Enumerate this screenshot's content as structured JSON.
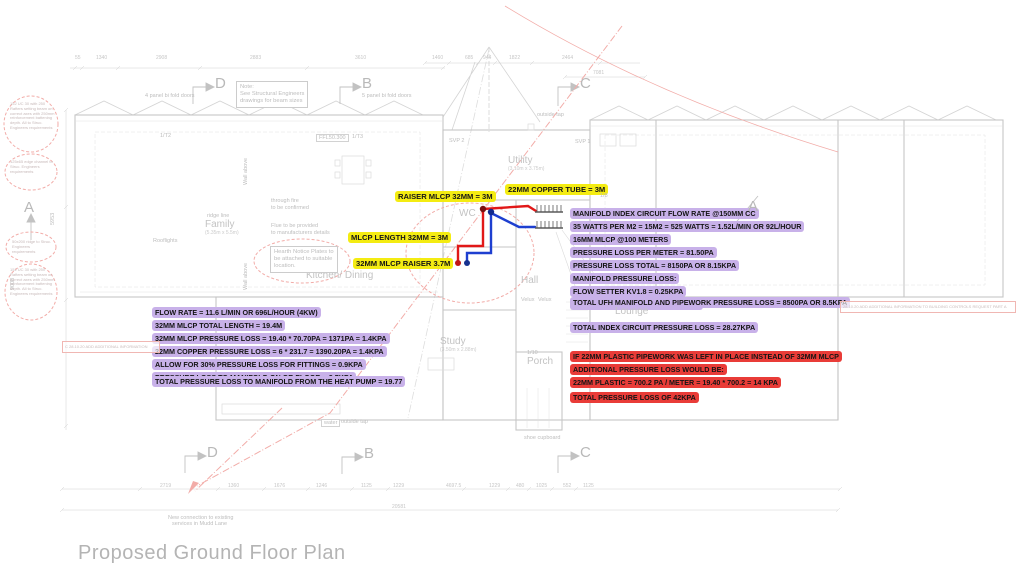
{
  "title": "Proposed Ground Floor Plan",
  "colors": {
    "yellow_highlight": "#f4ec12",
    "purple_highlight": "#c8b1e9",
    "red_highlight": "#e93c38",
    "pink_revision": "#f2aca8",
    "plan_gray": "#c9c9c9",
    "pipe_flow_red": "#e11818",
    "pipe_return_blue": "#1e3fd0"
  },
  "callouts": [
    {
      "color": "yellow",
      "x": 395,
      "y": 190,
      "lines": [
        "RAISER MLCP 32MM = 3M"
      ]
    },
    {
      "color": "yellow",
      "x": 505,
      "y": 183,
      "lines": [
        "22MM COPPER TUBE = 3M"
      ]
    },
    {
      "color": "yellow",
      "x": 348,
      "y": 231,
      "lines": [
        "MLCP LENGTH 32MM = 3M"
      ]
    },
    {
      "color": "yellow",
      "x": 353,
      "y": 257,
      "lines": [
        "32MM MLCP RAISER 3.7M"
      ]
    },
    {
      "color": "purple",
      "x": 570,
      "y": 207,
      "lines": [
        "MANIFOLD INDEX CIRCUIT FLOW RATE @150MM CC",
        "35 WATTS PER M2 = 15M2 = 525 WATTS = 1.52L/MIN OR 92L/HOUR",
        "16MM MLCP @100 METERS",
        "PRESSURE LOSS PER METER = 81.50PA",
        "PRESSURE LOSS TOTAL = 8150PA OR 8.15KPA",
        "MANIFOLD PRESSURE LOSS:",
        "FLOW SETTER KV1.8 = 0.25KPA",
        "RETURN MANIFOLD KV 2.8 = 0.1KPA"
      ]
    },
    {
      "color": "purple",
      "x": 570,
      "y": 296,
      "lines": [
        "TOTAL UFH MANIFOLD AND PIPEWORK PRESSURE LOSS = 8500PA OR 8.5KPA"
      ]
    },
    {
      "color": "purple",
      "x": 570,
      "y": 321,
      "lines": [
        "TOTAL INDEX CIRCUIT PRESSURE LOSS = 28.27KPA"
      ]
    },
    {
      "color": "purple",
      "x": 152,
      "y": 306,
      "lines": [
        "FLOW RATE = 11.6 L/MIN OR 696L/HOUR (4KW)",
        "32MM MLCP TOTAL LENGTH = 19.4M",
        "32MM MLCP PRESSURE LOSS = 19.40 * 70.70PA = 1371PA = 1.4KPA",
        "22MM COPPER PRESSURE LOSS = 6 * 231.7 = 1390.20PA = 1.4KPA",
        "ALLOW FOR 30% PRESSURE LOSS FOR FITTINGS = 0.9KPA",
        "PRESSURE LOSS TO MANIFOLD ON GR FLOOR = 3.7KPA"
      ]
    },
    {
      "color": "purple",
      "x": 152,
      "y": 375,
      "lines": [
        "TOTAL PRESSURE LOSS TO MANIFOLD FROM THE HEAT PUMP = 19.77"
      ]
    },
    {
      "color": "red",
      "x": 570,
      "y": 350,
      "lines": [
        "IF 22MM PLASTIC PIPEWORK WAS LEFT IN PLACE INSTEAD OF 32MM MLCP",
        "ADDITIONAL PRESSURE LOSS WOULD BE:",
        "22MM PLASTIC = 700.2 PA / METER = 19.40 * 700.2 = 14 KPA"
      ]
    },
    {
      "color": "red",
      "x": 570,
      "y": 391,
      "lines": [
        "TOTAL PRESSURE LOSS OF 42KPA"
      ]
    }
  ],
  "rooms": [
    {
      "name": "Family",
      "sub": "(5.35m x 5.5m)",
      "x": 205,
      "y": 220
    },
    {
      "name": "Kitchen/ Dining",
      "x": 306,
      "y": 271
    },
    {
      "name": "Utility",
      "sub": "(3.10m x 3.75m)",
      "x": 508,
      "y": 156
    },
    {
      "name": "WC",
      "x": 459,
      "y": 209
    },
    {
      "name": "Hall",
      "x": 521,
      "y": 276
    },
    {
      "name": "Study",
      "sub": "(3.50m x 2.88m)",
      "x": 440,
      "y": 337
    },
    {
      "name": "Porch",
      "x": 527,
      "y": 357
    },
    {
      "name": "Lounge",
      "x": 615,
      "y": 307
    }
  ],
  "note_boxes": [
    {
      "x": 236,
      "y": 81,
      "lines": [
        "Note:",
        "See Structural Engineers",
        "drawings for beam sizes"
      ]
    },
    {
      "x": 270,
      "y": 246,
      "lines": [
        "Hearth Notice Plates to",
        "be attached to suitable",
        "location."
      ]
    }
  ],
  "notes": [
    {
      "t": "4 panel bi fold doors",
      "x": 145,
      "y": 93
    },
    {
      "t": "5 panel bi fold doors",
      "x": 362,
      "y": 93
    },
    {
      "t": "through fire",
      "x": 271,
      "y": 198
    },
    {
      "t": "to be confirmed",
      "x": 271,
      "y": 205
    },
    {
      "t": "Flue to be provided",
      "x": 271,
      "y": 223
    },
    {
      "t": "to manufacturers details",
      "x": 271,
      "y": 230
    },
    {
      "t": "ridge line",
      "x": 207,
      "y": 213
    },
    {
      "t": "Rooflights",
      "x": 153,
      "y": 238
    },
    {
      "t": "Wall above",
      "x": 243,
      "y": 185,
      "rot": 1
    },
    {
      "t": "Wall above",
      "x": 243,
      "y": 290,
      "rot": 1
    },
    {
      "t": "outside tap",
      "x": 537,
      "y": 112
    },
    {
      "t": "outside tap",
      "x": 341,
      "y": 419
    },
    {
      "t": "water",
      "x": 321,
      "y": 419,
      "box": 1
    },
    {
      "t": "shoe cupboard",
      "x": 524,
      "y": 435
    },
    {
      "t": "FFL50.300",
      "x": 316,
      "y": 134,
      "box": 1
    },
    {
      "t": "1/T2",
      "x": 160,
      "y": 133
    },
    {
      "t": "1/T3",
      "x": 352,
      "y": 134
    },
    {
      "t": "1/10",
      "x": 527,
      "y": 350
    },
    {
      "t": "1/8",
      "x": 600,
      "y": 193
    },
    {
      "t": "SVP 2",
      "x": 449,
      "y": 138
    },
    {
      "t": "SVP 1",
      "x": 575,
      "y": 139
    },
    {
      "t": "Velux",
      "x": 521,
      "y": 297
    },
    {
      "t": "Velux",
      "x": 538,
      "y": 297
    },
    {
      "t": "New connection to existing",
      "x": 168,
      "y": 515
    },
    {
      "t": "services in Mudd Lane",
      "x": 172,
      "y": 521
    },
    {
      "t": "5953",
      "x": 50,
      "y": 225,
      "rot": 1
    },
    {
      "t": "9008",
      "x": 10,
      "y": 290,
      "rot": 1
    }
  ],
  "revision_rows": [
    {
      "t": "C   28.10.20   ADD ADDITIONAL INFORMATION",
      "x": 62,
      "y": 341,
      "w": 92
    },
    {
      "t": "28.10.20    ADD ADDITIONAL INFORMATION TO BUILDING CONTROLS REQUEST PART A",
      "x": 840,
      "y": 301,
      "w": 170
    }
  ],
  "cloud_texts": [
    {
      "t": "152 UC 30 with 250 Rafters setting beam on correct axes with 250mm reinforcement battening depth. All to Struc. Engineers requirements",
      "x": 10,
      "y": 102,
      "w": 46
    },
    {
      "t": "125x65 edge channel to Struc. Engineers requirements",
      "x": 10,
      "y": 160,
      "w": 44
    },
    {
      "t": "50x200 ridge to Struc. Engineers requirements",
      "x": 12,
      "y": 240,
      "w": 42
    },
    {
      "t": "152 UC 30 with 250 Rafters setting beam on correct axes with 250mm reinforcement battening depth. All to Struc. Engineers requirements",
      "x": 10,
      "y": 268,
      "w": 46
    }
  ],
  "dims": [
    {
      "t": "55",
      "x": 75,
      "y": 55
    },
    {
      "t": "1340",
      "x": 96,
      "y": 55
    },
    {
      "t": "2908",
      "x": 156,
      "y": 55
    },
    {
      "t": "2883",
      "x": 250,
      "y": 55
    },
    {
      "t": "3610",
      "x": 355,
      "y": 55
    },
    {
      "t": "1460",
      "x": 432,
      "y": 55
    },
    {
      "t": "685",
      "x": 465,
      "y": 55
    },
    {
      "t": "944",
      "x": 483,
      "y": 55
    },
    {
      "t": "1822",
      "x": 509,
      "y": 55
    },
    {
      "t": "2464",
      "x": 562,
      "y": 55
    },
    {
      "t": "7081",
      "x": 593,
      "y": 70
    },
    {
      "t": "2719",
      "x": 160,
      "y": 483
    },
    {
      "t": "1360",
      "x": 228,
      "y": 483
    },
    {
      "t": "1676",
      "x": 274,
      "y": 483
    },
    {
      "t": "1246",
      "x": 316,
      "y": 483
    },
    {
      "t": "1125",
      "x": 361,
      "y": 483
    },
    {
      "t": "1229",
      "x": 393,
      "y": 483
    },
    {
      "t": "4697.5",
      "x": 446,
      "y": 483
    },
    {
      "t": "1229",
      "x": 489,
      "y": 483
    },
    {
      "t": "480",
      "x": 516,
      "y": 483
    },
    {
      "t": "1025",
      "x": 536,
      "y": 483
    },
    {
      "t": "552",
      "x": 563,
      "y": 483
    },
    {
      "t": "1125",
      "x": 583,
      "y": 483
    },
    {
      "t": "20581",
      "x": 392,
      "y": 504
    }
  ],
  "section_markers": [
    {
      "letter": "D",
      "x": 215,
      "y": 76
    },
    {
      "letter": "B",
      "x": 362,
      "y": 76
    },
    {
      "letter": "C",
      "x": 580,
      "y": 76
    },
    {
      "letter": "D",
      "x": 207,
      "y": 445
    },
    {
      "letter": "B",
      "x": 364,
      "y": 446
    },
    {
      "letter": "C",
      "x": 580,
      "y": 445
    },
    {
      "letter": "A",
      "x": 24,
      "y": 200
    },
    {
      "letter": "A",
      "x": 748,
      "y": 199
    }
  ]
}
